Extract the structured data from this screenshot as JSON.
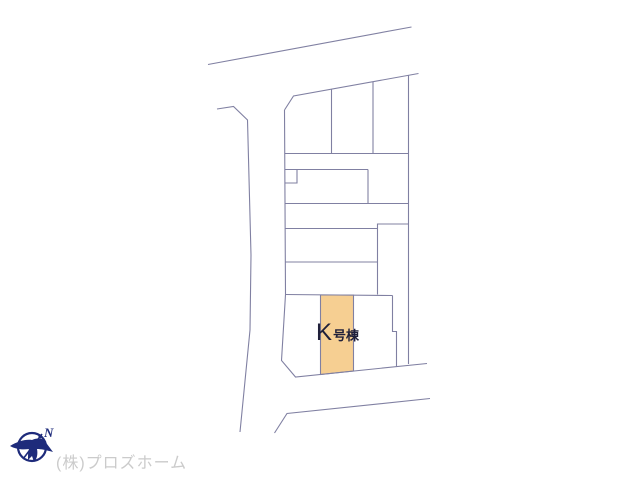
{
  "colors": {
    "page-bg": "#ffffff",
    "line": "#8080a2",
    "parcel-fill": "#f6cf92",
    "parcel-stroke": "#8080a2",
    "label-text": "#20203a",
    "compass-navy": "#1e2b7b",
    "company-text": "#cbcbcb"
  },
  "site_plan": {
    "highlighted_parcel": {
      "label_main": "K",
      "label_suffix": "号棟"
    },
    "compass": {
      "letter": "N"
    },
    "footer": {
      "company_name": "(株)プロズホーム"
    }
  }
}
